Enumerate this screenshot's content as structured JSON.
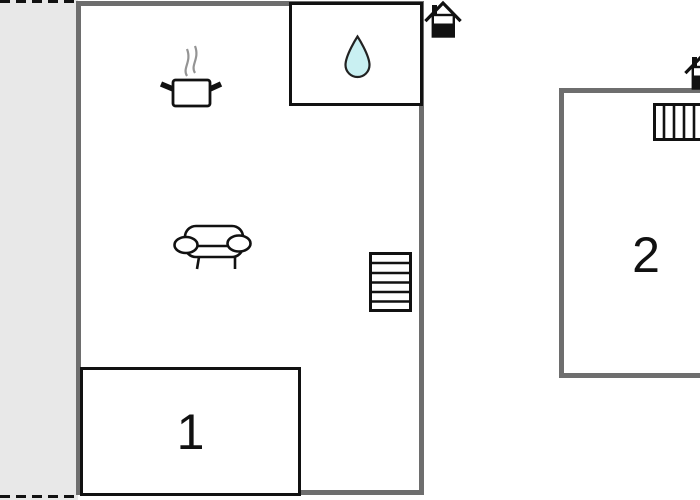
{
  "plan": {
    "rooms": [
      {
        "label": "1"
      },
      {
        "label": "2"
      }
    ],
    "colors": {
      "wall": "#6e6e6e",
      "outline": "#111111",
      "terrace_fill": "#e8e8e8",
      "water_drop_fill": "#c9f0f2",
      "steam": "#949494"
    },
    "icons": {
      "kitchen": "cooking-pot-icon",
      "bathroom": "water-drop-icon",
      "living_area": "sofa-icon",
      "main_building_stairs": "stairs-icon",
      "annex_stairs": "stairs-icon",
      "main_building_entrance": "entrance-house-icon",
      "annex_entrance": "entrance-house-icon"
    }
  }
}
